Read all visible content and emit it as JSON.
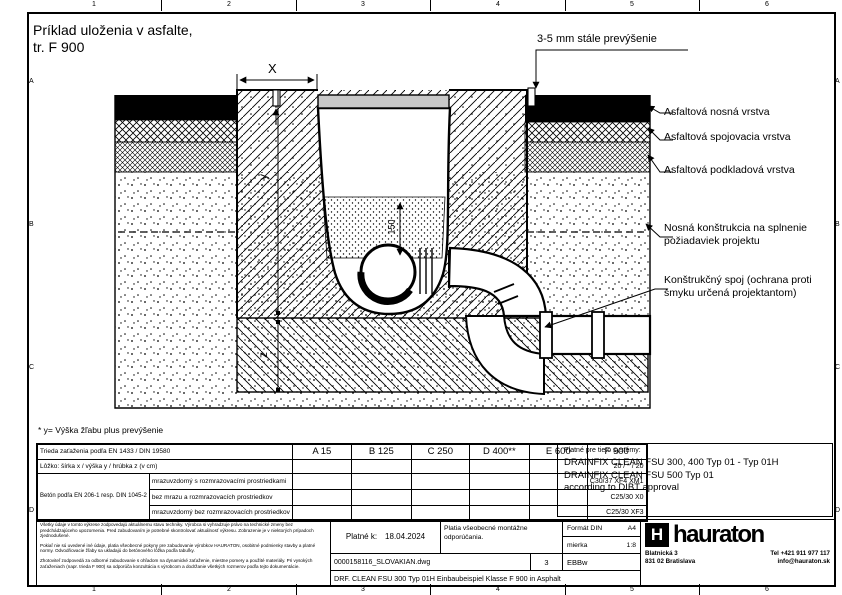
{
  "frame": {
    "columns": [
      "1",
      "2",
      "3",
      "4",
      "5",
      "6"
    ],
    "rows": [
      "A",
      "B",
      "C",
      "D"
    ]
  },
  "header": {
    "title_line1": "Príklad uloženia v asfalte,",
    "title_line2": "tr. F 900"
  },
  "annotations": {
    "top_note": "3-5 mm stále prevýšenie",
    "layer_labels": [
      "Asfaltová nosná vrstva",
      "Asfaltová spojovacia vrstva",
      "Asfaltová podkladová vrstva",
      "Nosná konštrukcia na splnenie požiadaviek projektu",
      "Konštrukčný spoj (ochrana proti šmyku určená projektantom)"
    ],
    "footnote": "* y= Výška žľabu plus prevýšenie"
  },
  "dimensions": {
    "width": "X",
    "height": "y",
    "depth": "z",
    "sand_cover": "150"
  },
  "table": {
    "row_load_class_label": "Trieda zaťaženia podľa EN 1433 / DIN 19580",
    "classes": [
      "A 15",
      "B 125",
      "C 250",
      "D 400**",
      "E 600",
      "F 900"
    ],
    "row_bedding_label": "Lôžko: šírka x / výška y / hrúbka z (v cm)",
    "row_bedding_f900": "20 / * / 20",
    "concrete_group_label": "Betón podľa EN 206-1 resp. DIN 1045-2",
    "concrete_rows": [
      {
        "label": "mrazuvzdorný s rozmrazovacími prostriedkami",
        "f900": "C30/37 XF4 XM1"
      },
      {
        "label": "bez mrazu a rozmrazovacích prostriedkov",
        "f900": "C25/30 X0"
      },
      {
        "label": "mrazuvzdorný bez rozmrazovacích prostriedkov",
        "f900": "C25/30 XF3"
      }
    ]
  },
  "systems": {
    "heading": "Platné pre tieto systémy:",
    "line1": "DRAINFIX CLEAN FSU 300, 400 Typ 01 - Typ 01H",
    "line2": "DRAINFIX CLEAN FSU 500 Typ 01",
    "line3": "according to DIBT approval"
  },
  "titleblock": {
    "valid_label": "Platné k:",
    "valid_date": "18.04.2024",
    "note": "Platia všeobecné montážne odporúčania.",
    "format_label": "Formát DIN",
    "format_value": "A4",
    "scale_label": "mierka",
    "scale_value": "1:8",
    "file_name": "0000158116_SLOVAKIAN.dwg",
    "sheet_no": "3",
    "author_code": "EBBw",
    "drawing_title": "DRF. CLEAN FSU 300 Typ 01H Einbaubeispiel Klasse F 900 in Asphalt",
    "disclaimer_p1": "Všetky údaje v tomto výkrese zodpovedajú aktuálnemu stavu techniky. Výrobca si vyhradzuje právo na technické zmeny bez predchádzajúceho upozornenia. Pred zabudovaním je potrebné skontrolovať aktuálnosť výkresu. Zobrazenie je v niektorých prípadoch zjednodušené.",
    "disclaimer_p2": "Pokiaľ nie sú uvedené iné údaje, platia všeobecné pokyny pre zabudovanie výrobkov HAURATON, osobitné podmienky stavby a platné normy. Odvodňovacie žľaby sa ukladajú do betónového lôžka podľa tabuľky.",
    "disclaimer_p3": "Zhotoviteľ zodpovedá za odborné zabudovanie s ohľadom na dynamické zaťaženie, miestne pomery a použité materiály. Pri vysokých zaťaženiach (napr. trieda F 900) sa odporúča konzultácia s výrobcom a dodržanie všetkých rozmerov podľa tejto dokumentácie.",
    "company": {
      "name": "hauraton",
      "logo_letter": "H",
      "address_line1": "Blatnická 3",
      "address_line2": "831 02 Bratislava",
      "phone": "Tel +421 911 977 117",
      "email": "info@hauraton.sk"
    }
  }
}
